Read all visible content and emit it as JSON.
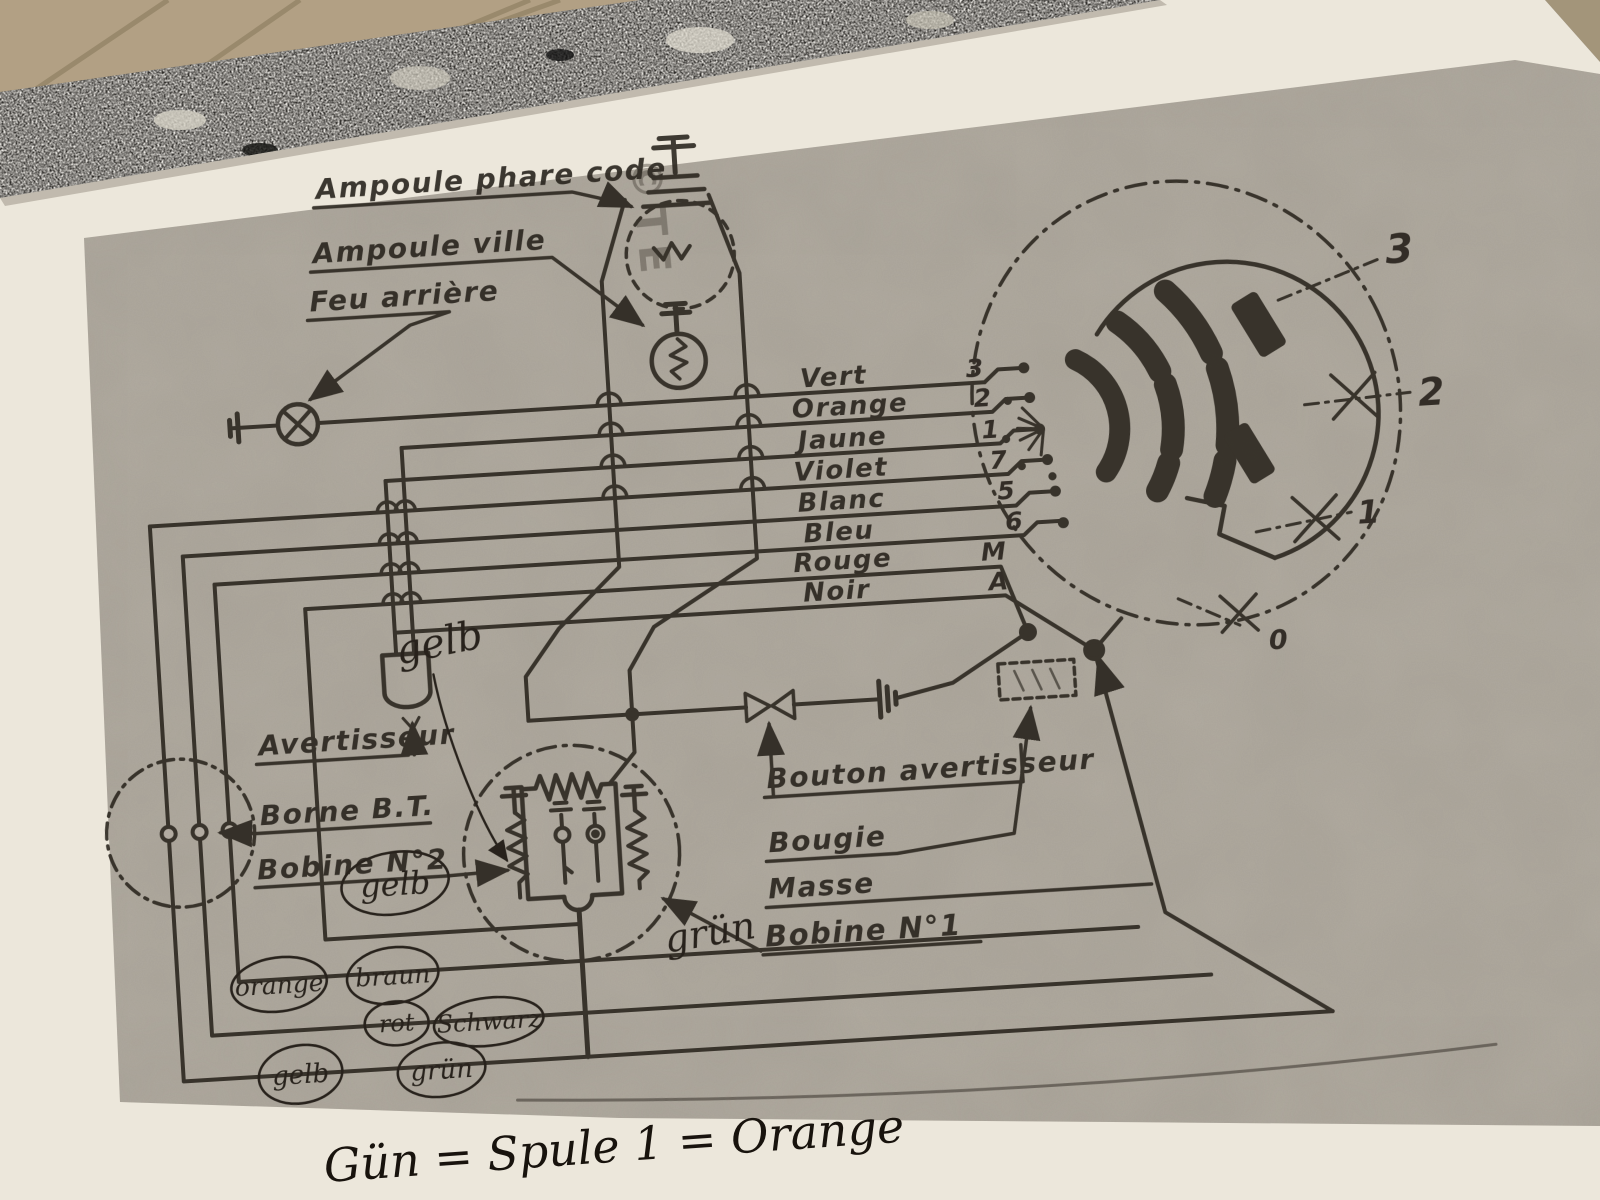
{
  "colors": {
    "ink": "#27221b",
    "pen_ink": "#18130d",
    "photocopy_gray": "#b2aca1",
    "paper_white": "#ece7db",
    "granite_dark": "#2e2c29",
    "floor_tan": "#b2a084"
  },
  "watermark": {
    "text": "©TE"
  },
  "diagram": {
    "component_labels": {
      "ampoule_phare_code": "Ampoule phare code",
      "ampoule_ville": "Ampoule ville",
      "feu_arriere": "Feu arrière",
      "avertisseur": "Avertisseur",
      "borne_bt": "Borne B.T.",
      "bobine_n2": "Bobine N°2",
      "bouton_avertisseur": "Bouton avertisseur",
      "bougie": "Bougie",
      "masse": "Masse",
      "bobine_n1": "Bobine N°1"
    },
    "wires": [
      {
        "color": "Vert",
        "terminal": "3"
      },
      {
        "color": "Orange",
        "terminal": "2"
      },
      {
        "color": "Jaune",
        "terminal": "1"
      },
      {
        "color": "Violet",
        "terminal": "7"
      },
      {
        "color": "Blanc",
        "terminal": "5"
      },
      {
        "color": "Bleu",
        "terminal": "6"
      },
      {
        "color": "Rouge",
        "terminal": "M"
      },
      {
        "color": "Noir",
        "terminal": "A"
      }
    ],
    "switch_positions": [
      "3",
      "2",
      "1",
      "0"
    ]
  },
  "handwriting": {
    "gelb_script": "gelb",
    "gelb_circled_mid": "gelb",
    "gruen_script": "grün",
    "circled_colors": [
      "orange",
      "braun",
      "rot",
      "Schwarz",
      "gelb",
      "grün"
    ],
    "bottom_note": "Gün  =  Spule 1  =  Orange"
  }
}
